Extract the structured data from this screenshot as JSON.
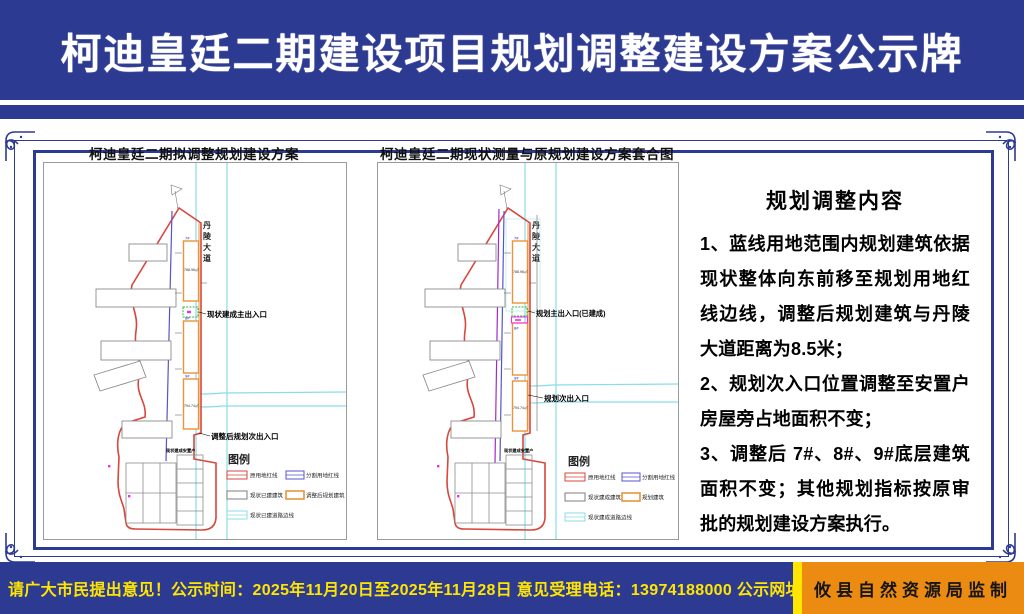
{
  "colors": {
    "navy": "#2d3a92",
    "footer_yellow": "#ffe600",
    "agency_orange": "#ec8b12",
    "boundary_red": "#d9463c",
    "divide_blue": "#5555cc",
    "plan_purple": "#a428c8",
    "road_cyan": "#8adce9",
    "building_orange": "#e8943a",
    "existing_gray": "#7d7d7d",
    "highlight_magenta": "#f02bf0"
  },
  "header": {
    "title": "柯迪皇廷二期建设项目规划调整建设方案公示牌"
  },
  "panels": {
    "left": {
      "title": "柯迪皇廷二期拟调整规划建设方案",
      "road_label": "丹陵大道",
      "building_ids": [
        "7#",
        "8#",
        "9#"
      ],
      "area_labels": [
        "788.96㎡",
        "794.74㎡"
      ],
      "entrance_main": "现状建成主出入口",
      "entrance_secondary": "调整后规划次出入口",
      "resettlement_label": "现状建成安置户",
      "legend": {
        "title": "图例",
        "items": [
          {
            "label": "原用地红线",
            "color": "#d9463c"
          },
          {
            "label": "分割用地红线",
            "color": "#5555cc"
          },
          {
            "label": "现状已建建筑",
            "color": "#7d7d7d"
          },
          {
            "label": "调整后规划建筑",
            "color": "#e8943a"
          },
          {
            "label": "现状已建道路边线",
            "color": "#8adce9"
          }
        ]
      }
    },
    "right": {
      "title": "柯迪皇廷二期现状测量与原规划建设方案套合图",
      "road_label": "丹陵大道",
      "building_ids": [
        "7#",
        "8#",
        "9#"
      ],
      "area_labels": [
        "788.96㎡",
        "794.74㎡"
      ],
      "entrance_main": "规划主出入口(已建成)",
      "entrance_secondary": "规划次出入口",
      "resettlement_label": "现状建成安置户",
      "legend": {
        "title": "图例",
        "items": [
          {
            "label": "原用地红线",
            "color": "#d9463c"
          },
          {
            "label": "分割用地红线",
            "color": "#5555cc"
          },
          {
            "label": "现状建成建筑",
            "color": "#7d7d7d"
          },
          {
            "label": "规划建筑",
            "color": "#e8943a"
          },
          {
            "label": "现状建成道路边线",
            "color": "#8adce9"
          }
        ]
      }
    }
  },
  "content": {
    "title": "规划调整内容",
    "items": [
      "1、蓝线用地范围内规划建筑依据现状整体向东前移至规划用地红线边线，调整后规划建筑与丹陵大道距离为8.5米；",
      "2、规划次入口位置调整至安置户房屋旁占地面积不变；",
      "3、调整后 7#、8#、9#底层建筑面积不变；其他规划指标按原审批的规划建设方案执行。"
    ]
  },
  "footer": {
    "notice": "请广大市民提出意见！公示时间：2025年11月20日至2025年11月28日  意见受理电话：13974188000  公示网址：www.hnyx.gov.cn",
    "agency": "攸县自然资源局监制"
  }
}
